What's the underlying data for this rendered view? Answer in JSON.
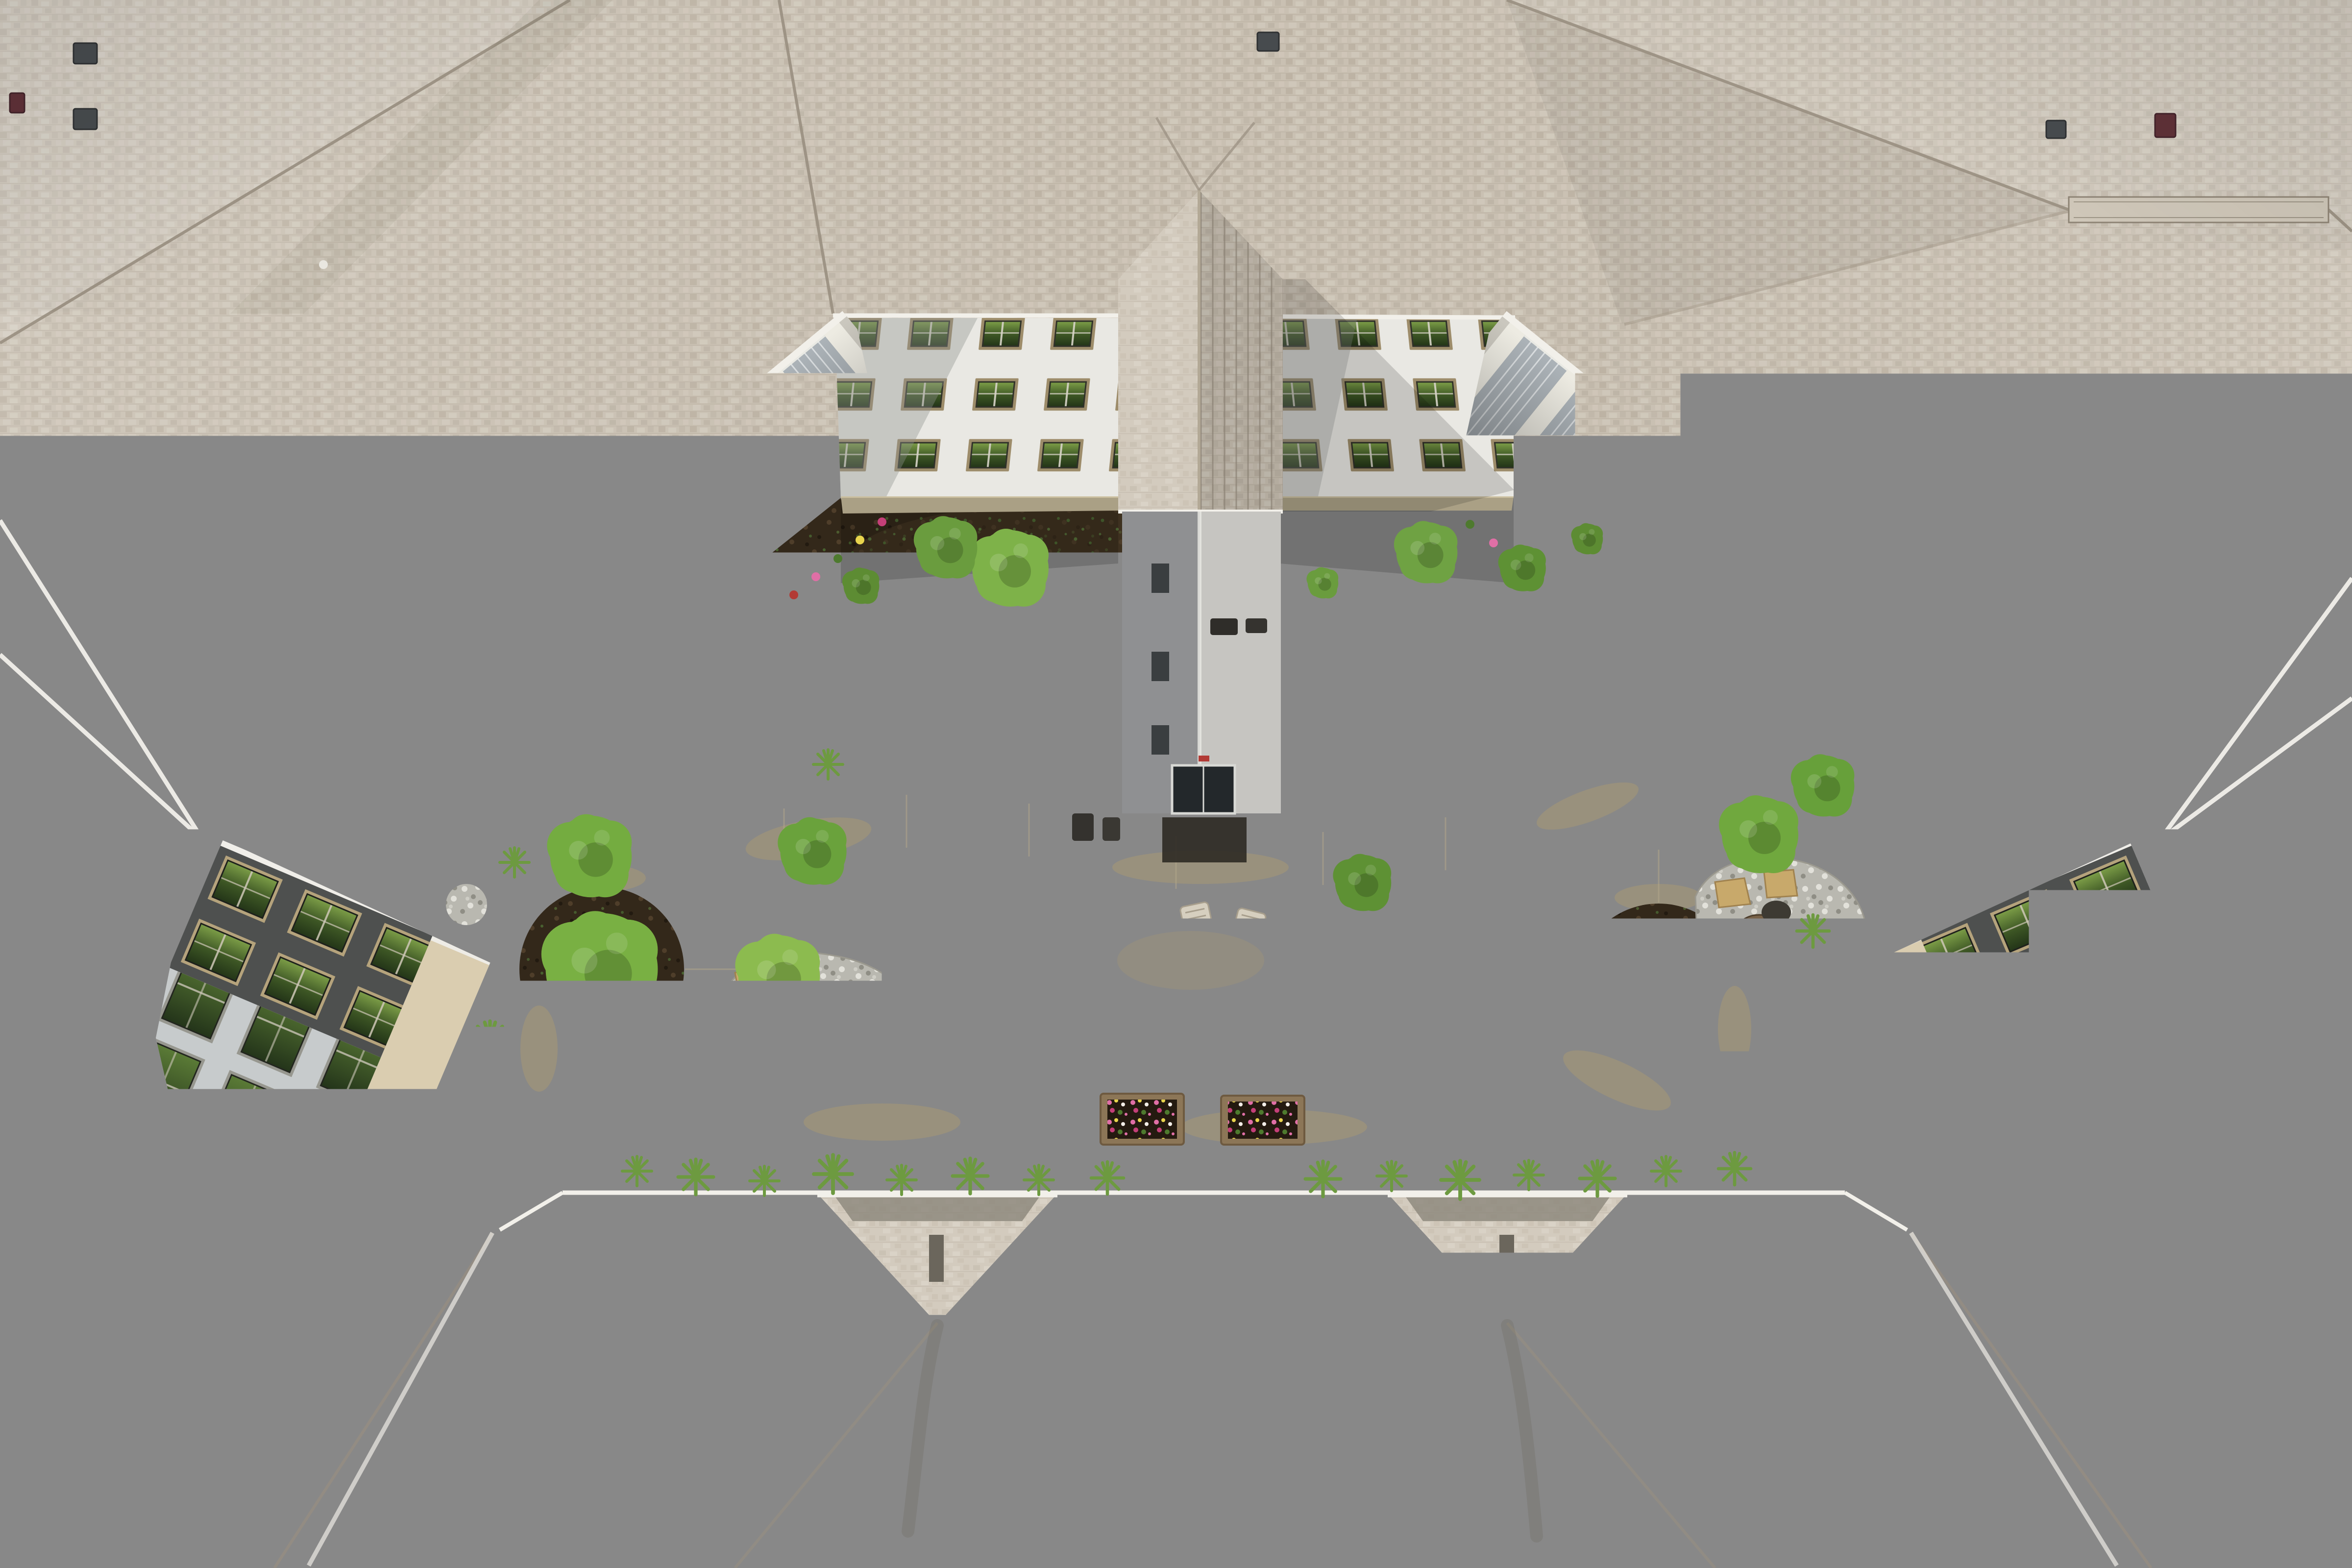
{
  "meta": {
    "domain": "Natural-Image",
    "title": "Aerial drone view of a U-shaped apartment building courtyard",
    "description": "Top-down photograph: shingled rooftops surround a central courtyard with a looping concrete walking path, lawn, pergola with seating, raised flower planters, decomposed-granite plaza, river-rock gravel beds, rock gardens with boulders, mulch planting beds, balconies with glass canopies, and a gabled entry tower."
  },
  "palette": {
    "shingle_base": "#c9c0b2",
    "shingle_dark": "#b2a899",
    "shingle_light": "#d6cec1",
    "shingle_gray": "#c2bbb0",
    "shingle_pale": "#d3cbbe",
    "roof_seam": "#998f80",
    "roof_ridge": "#cfc7b9",
    "stain_dark": "#57503f",
    "gutter_white": "#f2f0ea",
    "panel_white": "#eef0f2",
    "panel_line": "#c7ccd2",
    "facade_white": "#e9e8e3",
    "facade_shadow": "#8e918e",
    "facade_dark": "#4e504f",
    "facade_gray": "#c7cbcc",
    "stone_beige": "#dacdb0",
    "sill_stone": "#cbbf9f",
    "window_frame_tan": "#9d8c6a",
    "window_frame_lt": "#b5a37c",
    "window_sash": "#2f3129",
    "glass_green_1": "#7a9b46",
    "glass_green_2": "#3c5524",
    "glass_deep": "#243618",
    "glass_dark": "#24351a",
    "canopy_gray": "#a9b1b6",
    "canopy_rib": "#e6e9ea",
    "canopy_shadow": "#2e3236",
    "deck_gray": "#cac7be",
    "patio_cream": "#d9d3c3",
    "tower_wall_dark": "#8f9092",
    "tower_wall_light": "#c6c5c1",
    "door_dark": "#23282b",
    "mat_dark": "#2e2a24",
    "mulch_dark": "#33281a",
    "mulch_clod": "#4f3e2a",
    "soil_light": "#4a3a26",
    "weed_green": "#4d6f35",
    "lawn_base": "#5f8531",
    "lawn_light": "#7fa24b",
    "lawn_dark": "#55782b",
    "lawn_dry": "#8d7d46",
    "path_concrete": "#d2c7a9",
    "path_light": "#d8cfb4",
    "path_stain": "#ab9a72",
    "path_joint": "#b3a88a",
    "dg_tan": "#c9a258",
    "dg_light": "#d9b873",
    "dg_dark": "#b88f49",
    "gravel_base": "#a7a7a2",
    "gravel_light": "#d6d6d0",
    "gravel_dark": "#7b7b74",
    "pebble_base": "#b9b8b0",
    "pebble_light": "#e2e1da",
    "pebble_dark": "#8f8e85",
    "flagstone": "#c8a96b",
    "flagstone_edge": "#a0824f",
    "boulder": "#786248",
    "boulder_dark": "#5d4c36",
    "pergola_wood": "#a49a86",
    "pergola_beam": "#8f8572",
    "pergola_shadow": "#5f5747",
    "furniture": "#d6cfbf",
    "planter_wood": "#8c7657",
    "planter_soil": "#241a10",
    "flower_pink": "#e06fa6",
    "flower_magenta": "#c43f78",
    "flower_yellow": "#e8d44d",
    "flower_white": "#f2ede7",
    "leaf_green": "#4e7a2e",
    "tree_bright": "#8cbb4f",
    "tree_mid": "#74ac40",
    "tree_deep": "#5e9134",
    "tuft_green": "#6d9a40",
    "vent_dark": "#474b4e",
    "vent_maroon": "#5f3138",
    "light_fixture": "#2b2a27",
    "utility_green": "#33502e"
  },
  "scene": {
    "features": [
      "rooftop shingles",
      "ridge vent",
      "roof vents",
      "white standing-seam panels",
      "gabled entry tower",
      "top wing apartments",
      "left wing balconies",
      "right wing balconies",
      "left corner block",
      "right corner block",
      "lower building gables",
      "courtyard lawn",
      "looping walking path",
      "path lights",
      "pergola with seating",
      "raised flower planters",
      "decomposed granite plaza",
      "river rock gravel beds",
      "rock gardens with boulders and flagstones",
      "mulch planting beds",
      "ornamental grasses",
      "trees and shrubs"
    ]
  }
}
